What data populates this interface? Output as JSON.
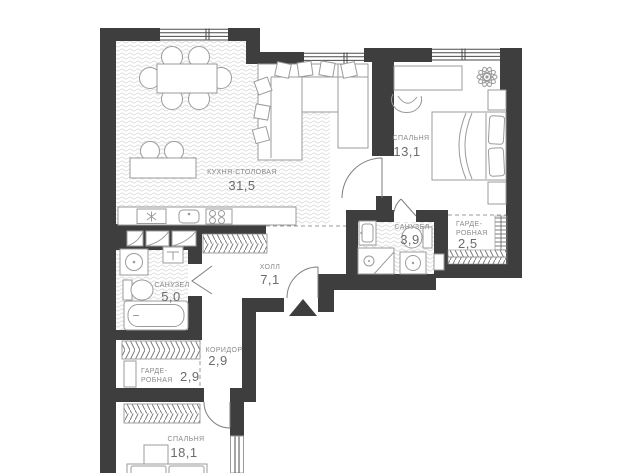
{
  "plan": {
    "type": "apartment-floor-plan",
    "rooms": [
      {
        "key": "kitchen-dining",
        "name": "КУХНЯ-СТОЛОВАЯ",
        "area": "31,5"
      },
      {
        "key": "bedroom-1",
        "name": "СПАЛЬНЯ",
        "area": "13,1"
      },
      {
        "key": "bathroom-1",
        "name": "САНУЗЕЛ",
        "area": "3,9"
      },
      {
        "key": "wardrobe-1",
        "name_lines": [
          "ГАРДЕ-",
          "РОБНАЯ"
        ],
        "area": "2,5"
      },
      {
        "key": "hall",
        "name": "ХОЛЛ",
        "area": "7,1"
      },
      {
        "key": "bathroom-2",
        "name": "САНУЗЕЛ",
        "area": "5,0"
      },
      {
        "key": "corridor",
        "name": "КОРИДОР",
        "area": "2,9"
      },
      {
        "key": "wardrobe-2",
        "name_lines": [
          "ГАРДЕ-",
          "РОБНАЯ"
        ],
        "area": "2,9"
      },
      {
        "key": "bedroom-2",
        "name": "СПАЛЬНЯ",
        "area": "18,1"
      }
    ],
    "colors": {
      "wall": "#3e3e3e",
      "furniture_line": "#9b9b9b",
      "floor_wave": "#dedede",
      "hatch": "#6f6f6f",
      "room_label": "#8a8a8a",
      "area_label": "#6b6b6b",
      "background": "#ffffff"
    }
  }
}
